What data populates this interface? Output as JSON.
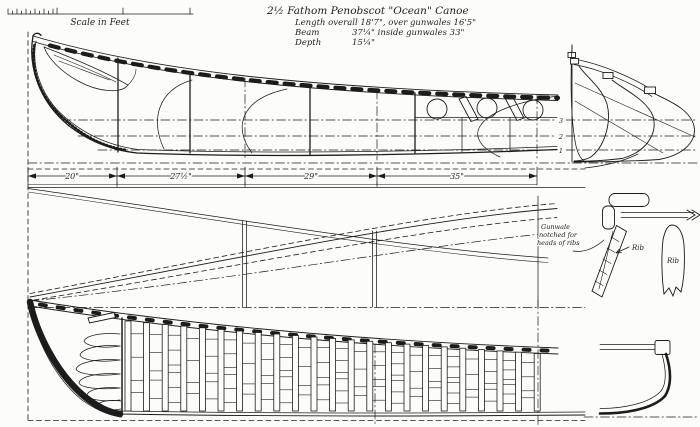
{
  "scale_bar": {
    "label": "Scale in Feet"
  },
  "title_block": {
    "title": "2½ Fathom Penobscot \"Ocean\" Canoe",
    "length_line": "Length overall 18'7\", over gunwales 16'5\"",
    "beam_label": "Beam",
    "beam_value": "37¼\"  inside gunwales 33\"",
    "depth_label": "Depth",
    "depth_value": "15¼\""
  },
  "dimensions": {
    "seg1": "20\"",
    "seg2": "27½\"",
    "seg3": "29\"",
    "seg4": "35\""
  },
  "waterlines": {
    "wl3": "3",
    "wl2": "2",
    "wl1": "1"
  },
  "details": {
    "gunwale_note_line1": "Gunwale",
    "gunwale_note_line2": "notched for",
    "gunwale_note_line3": "heads of ribs",
    "rib_label": "Rib",
    "rib_blade_label": "Rib"
  },
  "construction": {
    "rib_count": 23
  },
  "colors": {
    "ink": "#1c1c1c",
    "paper": "#fcfcfa"
  }
}
